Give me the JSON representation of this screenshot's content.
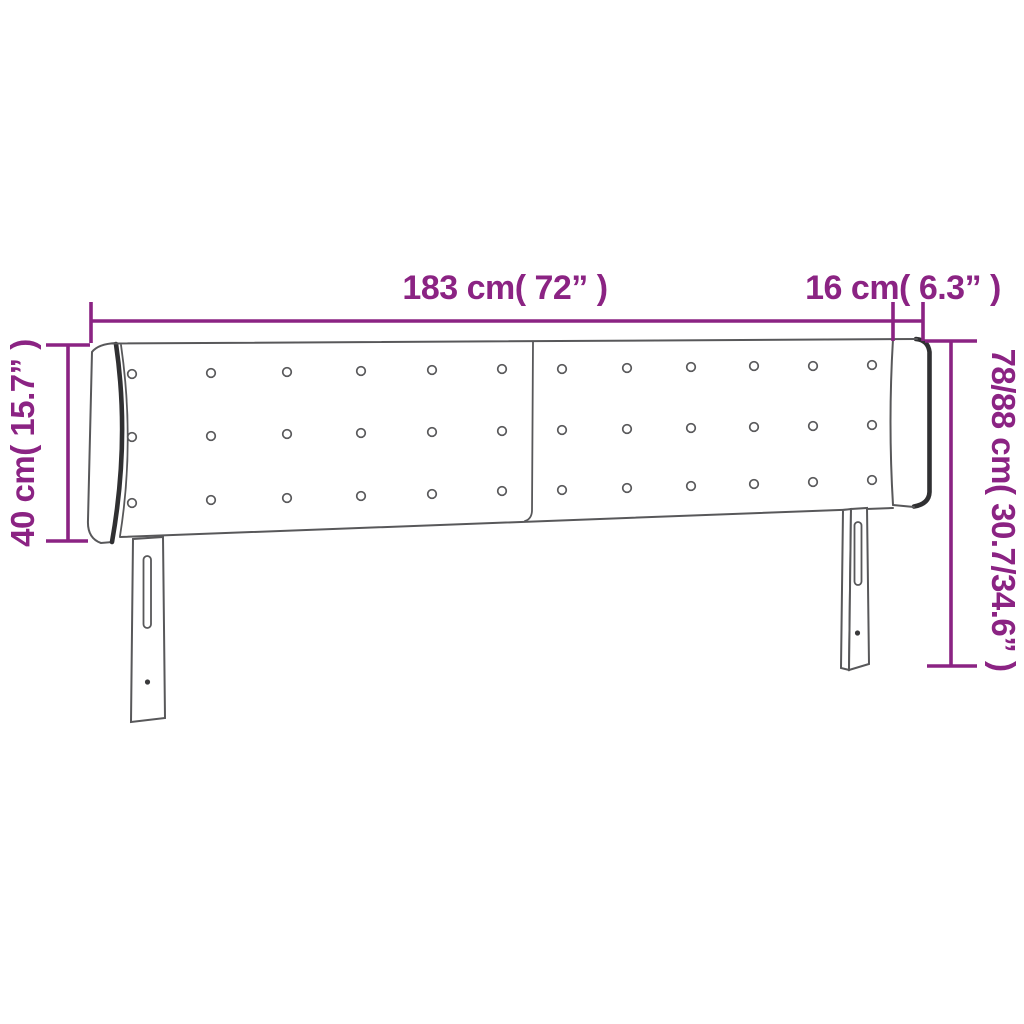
{
  "colors": {
    "dim": "#8b2383",
    "line": "#58585a",
    "dark": "#303032",
    "fill": "#ffffff",
    "screw": "#3a3a3c"
  },
  "dimensions": {
    "width": {
      "label": "183 cm( 72” )"
    },
    "wing": {
      "label": "16 cm( 6.3” )"
    },
    "panel_height": {
      "label": "40 cm( 15.7” )"
    },
    "total_height": {
      "label": "78/88 cm( 30.7/34.6” )"
    }
  },
  "headboard": {
    "panels": 2,
    "button_rows": 3,
    "button_columns": 12,
    "legs": 2
  }
}
